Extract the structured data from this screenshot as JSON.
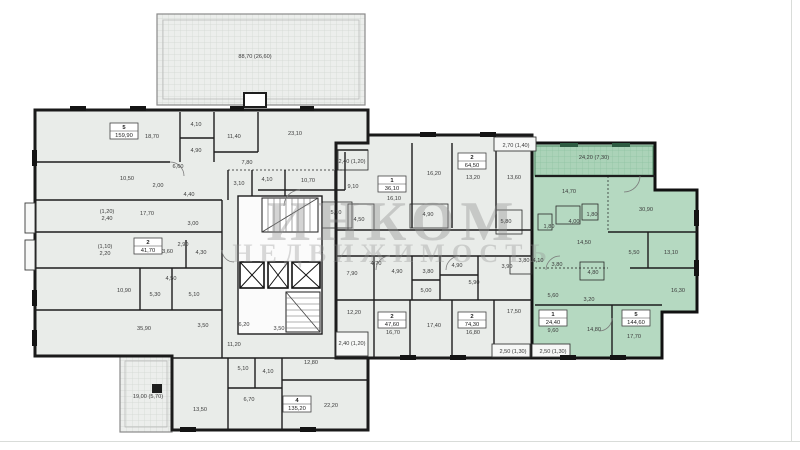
{
  "watermark": {
    "line1": "ИНКОМ",
    "line2": "НЕДВИЖИМОСТЬ"
  },
  "colors": {
    "highlight_fill": "#b5d9c1",
    "floor_fill": "#e9ece9",
    "wall": "#1a1a1a",
    "watermark_gray": "#8f8f8f"
  },
  "apartments": [
    {
      "number": "5",
      "area": "159,90",
      "x": 124,
      "y": 131
    },
    {
      "number": "2",
      "area": "41,70",
      "x": 148,
      "y": 246
    },
    {
      "number": "4",
      "area": "135,20",
      "x": 297,
      "y": 404
    },
    {
      "number": "1",
      "area": "36,10",
      "x": 392,
      "y": 184
    },
    {
      "number": "2",
      "area": "64,50",
      "x": 472,
      "y": 161
    },
    {
      "number": "2",
      "area": "47,60",
      "x": 392,
      "y": 320
    },
    {
      "number": "2",
      "area": "74,30",
      "x": 472,
      "y": 320
    },
    {
      "number": "1",
      "area": "24,40",
      "x": 553,
      "y": 318
    },
    {
      "number": "5",
      "area": "144,60",
      "x": 636,
      "y": 318,
      "highlighted": true
    }
  ],
  "labels": [
    {
      "t": "88,70 (26,60)",
      "x": 255,
      "y": 58
    },
    {
      "t": "18,70",
      "x": 152,
      "y": 138
    },
    {
      "t": "4,10",
      "x": 196,
      "y": 126
    },
    {
      "t": "4,90",
      "x": 196,
      "y": 152
    },
    {
      "t": "11,40",
      "x": 234,
      "y": 138
    },
    {
      "t": "23,10",
      "x": 295,
      "y": 135
    },
    {
      "t": "7,80",
      "x": 247,
      "y": 164
    },
    {
      "t": "6,60",
      "x": 178,
      "y": 168
    },
    {
      "t": "10,50",
      "x": 127,
      "y": 180
    },
    {
      "t": "2,00",
      "x": 158,
      "y": 187
    },
    {
      "t": "3,10",
      "x": 239,
      "y": 185
    },
    {
      "t": "4,10",
      "x": 267,
      "y": 181
    },
    {
      "t": "10,70",
      "x": 308,
      "y": 182
    },
    {
      "t": "4,40",
      "x": 189,
      "y": 196
    },
    {
      "t": "17,70",
      "x": 147,
      "y": 215
    },
    {
      "t": "3,00",
      "x": 193,
      "y": 225
    },
    {
      "t": "(1,20)",
      "x": 107,
      "y": 213
    },
    {
      "t": "2,40",
      "x": 107,
      "y": 220
    },
    {
      "t": "(1,10)",
      "x": 105,
      "y": 248
    },
    {
      "t": "2,20",
      "x": 105,
      "y": 255
    },
    {
      "t": "13,60",
      "x": 166,
      "y": 253
    },
    {
      "t": "2,90",
      "x": 183,
      "y": 246
    },
    {
      "t": "4,30",
      "x": 201,
      "y": 254
    },
    {
      "t": "10,90",
      "x": 124,
      "y": 292
    },
    {
      "t": "4,50",
      "x": 171,
      "y": 280
    },
    {
      "t": "5,30",
      "x": 155,
      "y": 296
    },
    {
      "t": "5,10",
      "x": 194,
      "y": 296
    },
    {
      "t": "35,90",
      "x": 144,
      "y": 330
    },
    {
      "t": "3,50",
      "x": 203,
      "y": 327
    },
    {
      "t": "6,20",
      "x": 244,
      "y": 326
    },
    {
      "t": "3,50",
      "x": 279,
      "y": 330
    },
    {
      "t": "11,20",
      "x": 234,
      "y": 346
    },
    {
      "t": "5,10",
      "x": 243,
      "y": 370
    },
    {
      "t": "4,10",
      "x": 268,
      "y": 373
    },
    {
      "t": "12,80",
      "x": 311,
      "y": 364
    },
    {
      "t": "6,70",
      "x": 249,
      "y": 401
    },
    {
      "t": "22,20",
      "x": 331,
      "y": 407
    },
    {
      "t": "13,50",
      "x": 200,
      "y": 411
    },
    {
      "t": "19,00 (5,70)",
      "x": 148,
      "y": 398
    },
    {
      "t": "5,10",
      "x": 336,
      "y": 214
    },
    {
      "t": "4,50",
      "x": 359,
      "y": 221
    },
    {
      "t": "4,90",
      "x": 428,
      "y": 216
    },
    {
      "t": "2,40 (1,20)",
      "x": 352,
      "y": 163
    },
    {
      "t": "9,10",
      "x": 353,
      "y": 188
    },
    {
      "t": "16,10",
      "x": 394,
      "y": 200
    },
    {
      "t": "16,20",
      "x": 434,
      "y": 175
    },
    {
      "t": "13,20",
      "x": 473,
      "y": 179
    },
    {
      "t": "2,70 (1,40)",
      "x": 516,
      "y": 147
    },
    {
      "t": "13,60",
      "x": 514,
      "y": 179
    },
    {
      "t": "5,80",
      "x": 506,
      "y": 223
    },
    {
      "t": "3,80",
      "x": 524,
      "y": 262
    },
    {
      "t": "4,70",
      "x": 376,
      "y": 265
    },
    {
      "t": "4,90",
      "x": 397,
      "y": 273
    },
    {
      "t": "3,80",
      "x": 428,
      "y": 273
    },
    {
      "t": "4,90",
      "x": 457,
      "y": 267
    },
    {
      "t": "3,90",
      "x": 507,
      "y": 268
    },
    {
      "t": "7,90",
      "x": 352,
      "y": 275
    },
    {
      "t": "5,90",
      "x": 474,
      "y": 284
    },
    {
      "t": "5,00",
      "x": 426,
      "y": 292
    },
    {
      "t": "12,20",
      "x": 354,
      "y": 314
    },
    {
      "t": "17,40",
      "x": 434,
      "y": 327
    },
    {
      "t": "16,70",
      "x": 393,
      "y": 334
    },
    {
      "t": "16,80",
      "x": 473,
      "y": 334
    },
    {
      "t": "17,50",
      "x": 514,
      "y": 313
    },
    {
      "t": "2,40 (1,20)",
      "x": 352,
      "y": 345
    },
    {
      "t": "2,50 (1,30)",
      "x": 513,
      "y": 353
    },
    {
      "t": "2,50 (1,30)",
      "x": 553,
      "y": 353
    },
    {
      "t": "4,10",
      "x": 538,
      "y": 262
    },
    {
      "t": "3,80",
      "x": 557,
      "y": 266
    },
    {
      "t": "5,60",
      "x": 553,
      "y": 297
    },
    {
      "t": "9,60",
      "x": 553,
      "y": 332
    },
    {
      "t": "24,20 (7,30)",
      "x": 594,
      "y": 159
    },
    {
      "t": "14,70",
      "x": 569,
      "y": 193
    },
    {
      "t": "30,90",
      "x": 646,
      "y": 211
    },
    {
      "t": "1,80",
      "x": 592,
      "y": 216
    },
    {
      "t": "4,00",
      "x": 574,
      "y": 223
    },
    {
      "t": "1,80",
      "x": 549,
      "y": 228
    },
    {
      "t": "14,50",
      "x": 584,
      "y": 244
    },
    {
      "t": "5,50",
      "x": 634,
      "y": 254
    },
    {
      "t": "13,10",
      "x": 671,
      "y": 254
    },
    {
      "t": "4,80",
      "x": 593,
      "y": 274
    },
    {
      "t": "16,30",
      "x": 678,
      "y": 292
    },
    {
      "t": "3,20",
      "x": 589,
      "y": 301
    },
    {
      "t": "14,80",
      "x": 594,
      "y": 331
    },
    {
      "t": "17,70",
      "x": 634,
      "y": 338
    }
  ]
}
